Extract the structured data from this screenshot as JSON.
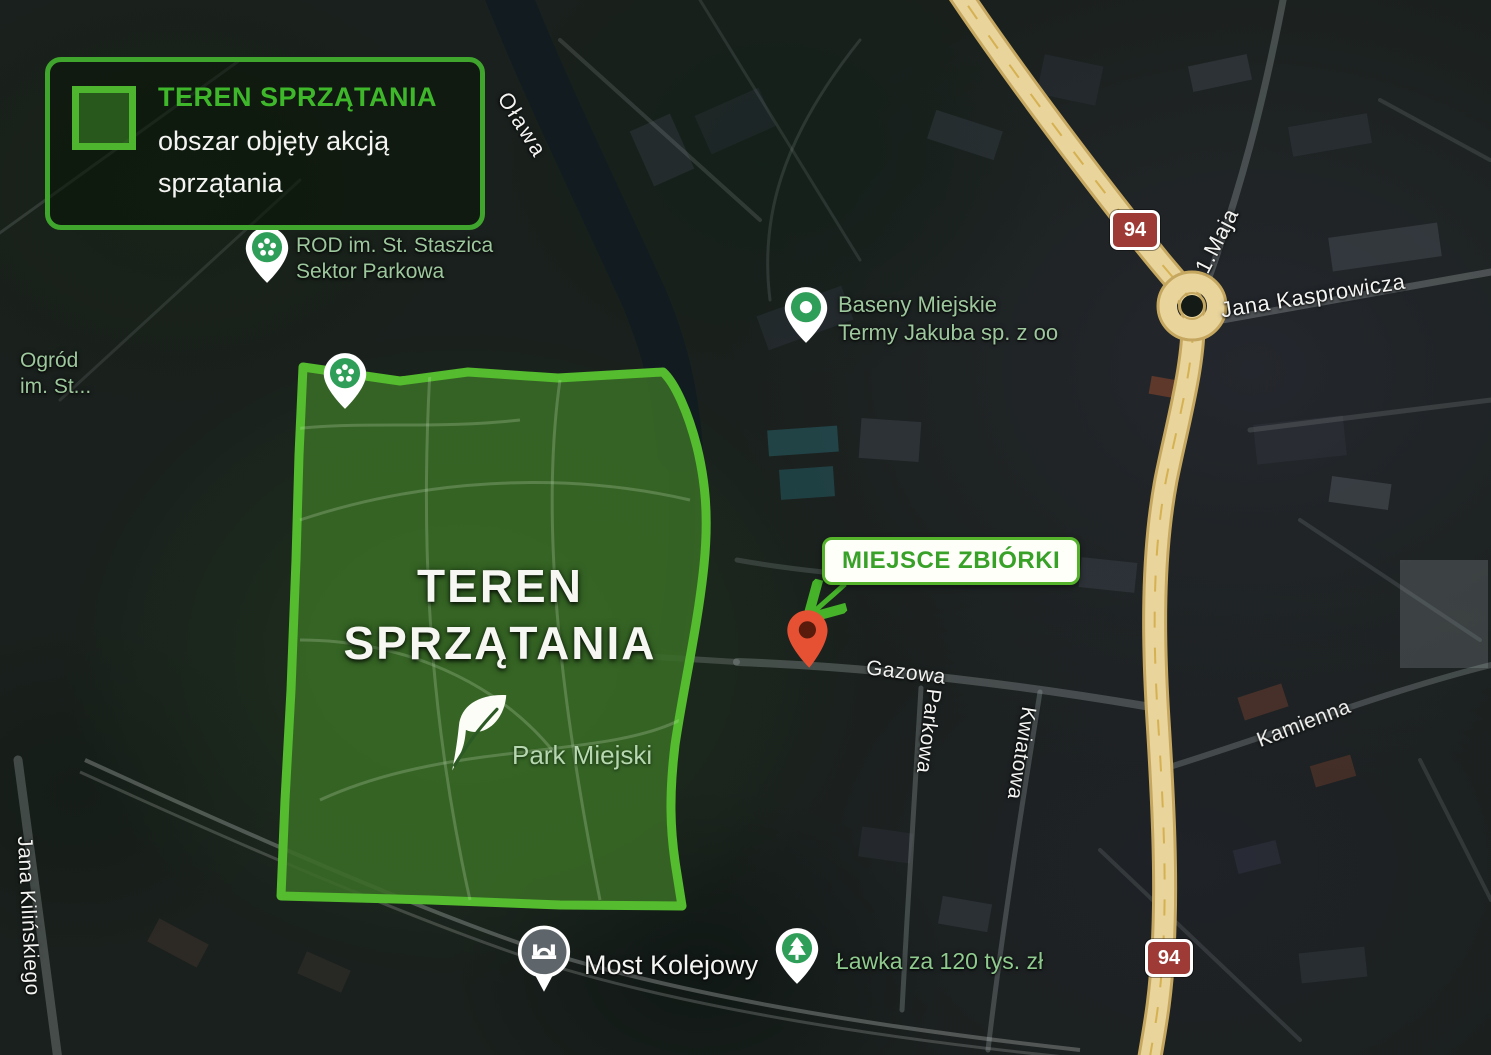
{
  "map": {
    "style": "satellite",
    "colors": {
      "accent_green": "#4db52e",
      "area_fill": "rgba(98,190,60,0.30)",
      "road_tan": "#e9d49c",
      "shield_red": "#9e3b36",
      "poi_label_green": "#9dc79c",
      "meeting_text_green": "#38a128"
    }
  },
  "legend": {
    "title": "TEREN SPRZĄTANIA",
    "line1": "obszar objęty akcją",
    "line2": "sprzątania",
    "swatch_icon": "cleanup-area-swatch"
  },
  "cleanup_area": {
    "title_line1": "TEREN",
    "title_line2": "SPRZĄTANIA",
    "park_name": "Park Miejski",
    "icon": "leaf-icon"
  },
  "meeting_point": {
    "label": "MIEJSCE ZBIÓRKI",
    "pin_icon": "red-map-pin"
  },
  "pois": [
    {
      "id": "rod-staszica",
      "line1": "ROD im. St. Staszica",
      "line2": "Sektor Parkowa",
      "icon": "garden-pin"
    },
    {
      "id": "ogrod",
      "line1": "Ogród",
      "line2": "im. St...",
      "icon": "garden-pin"
    },
    {
      "id": "baseny-miejskie",
      "line1": "Baseny Miejskie",
      "line2": "Termy Jakuba sp. z oo",
      "icon": "pool-pin"
    },
    {
      "id": "most-kolejowy",
      "label": "Most Kolejowy",
      "icon": "bridge-pin"
    },
    {
      "id": "lawka",
      "label": "Ławka za 120 tys. zł",
      "icon": "tree-pin"
    }
  ],
  "streets": {
    "olawa": "Oława",
    "gazowa": "Gazowa",
    "parkowa": "Parkowa",
    "kwiatowa": "Kwiatowa",
    "kamienna": "Kamienna",
    "jana_kasprowicza": "Jana Kasprowicza",
    "maja": "1.Maja",
    "jana_kilinskiego": "Jana Kilińskiego"
  },
  "road_shields": {
    "top": "94",
    "bottom": "94"
  }
}
